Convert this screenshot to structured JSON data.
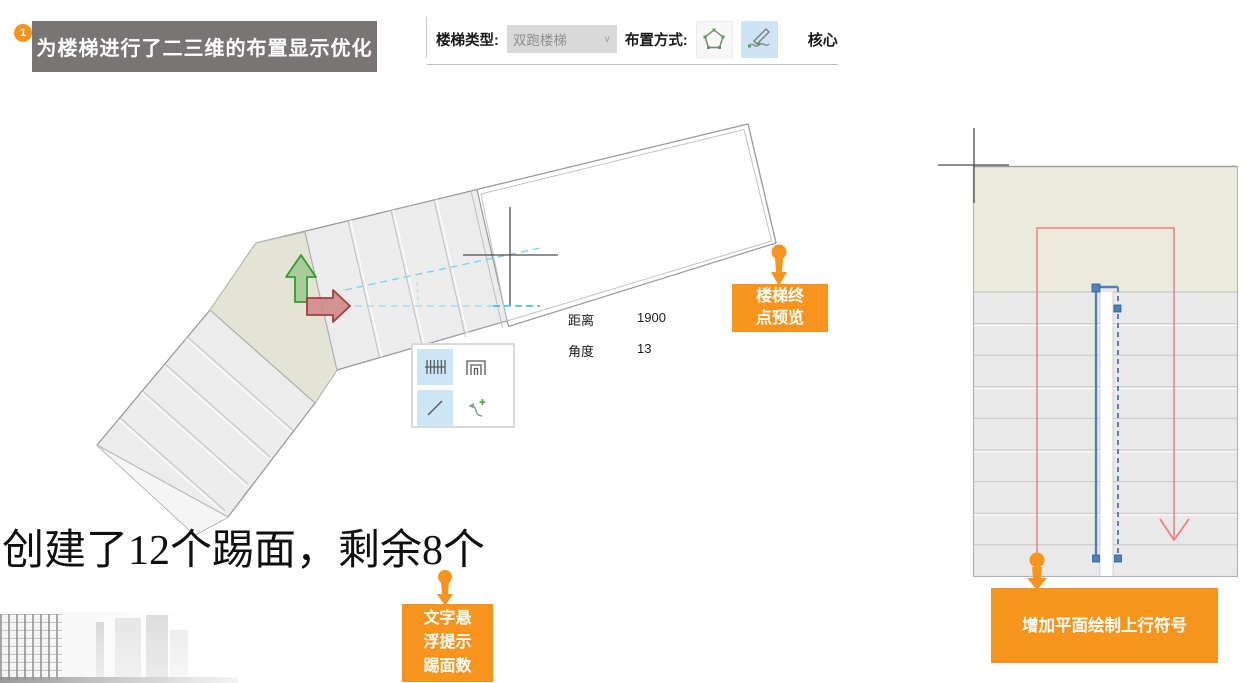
{
  "badge": {
    "label": "1"
  },
  "banner": {
    "text": "为楼梯进行了二三维的布置显示优化"
  },
  "toolbar": {
    "stair_type_label": "楼梯类型:",
    "stair_type_value": "双跑楼梯",
    "chevron": "∨",
    "placement_label": "布置方式:",
    "core_label": "核心",
    "buttons": [
      {
        "icon": "pentagon-draw-icon",
        "selected": false
      },
      {
        "icon": "sketch-draw-icon",
        "selected": true
      }
    ]
  },
  "readout": {
    "distance_label": "距离",
    "distance_value": "1900",
    "angle_label": "角度",
    "angle_value": "13"
  },
  "riser_status": {
    "text": "创建了12个踢面，剩余8个"
  },
  "mini_toolbar": {
    "buttons": [
      {
        "icon": "stair-run-icon",
        "selected": true
      },
      {
        "icon": "landing-icon",
        "selected": false
      },
      {
        "icon": "line-segment-icon",
        "selected": true
      },
      {
        "icon": "spline-add-icon",
        "selected": false
      }
    ]
  },
  "callouts": {
    "endpoint": {
      "lines": [
        "楼梯终",
        "点预览"
      ]
    },
    "hover_tip": {
      "lines": [
        "文字悬",
        "浮提示",
        "踢面数"
      ]
    },
    "up_symbol": {
      "lines": [
        "增加平面绘制上行符号"
      ]
    }
  },
  "colors": {
    "accent_orange": "#F7941D",
    "banner_gray": "#7A7575",
    "selection_blue": "#CDE6F5",
    "railing_blue": "#4F81BD",
    "guide_cyan": "#5FCBF4",
    "path_red": "#F08080",
    "landing_fill": "#E4E4D6",
    "tread_fill": "#ECECEC"
  }
}
